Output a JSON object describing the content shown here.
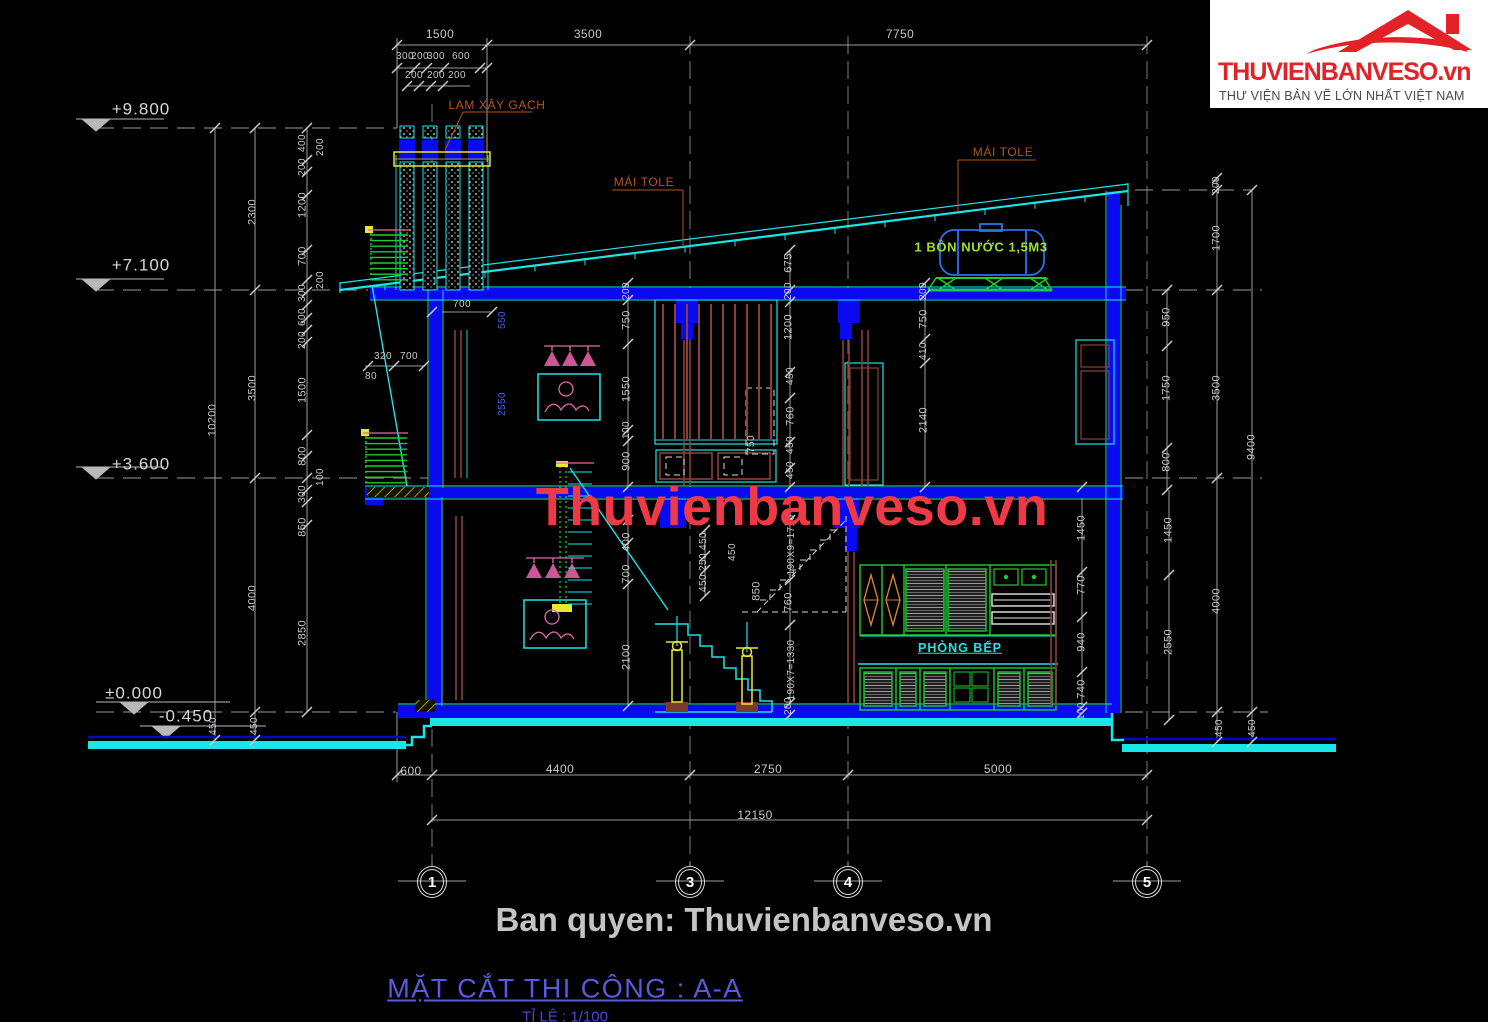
{
  "logo": {
    "brand": "THUVIENBANVESO.vn",
    "tagline": "THƯ VIỆN BẢN VẼ LỚN NHẤT VIỆT NAM"
  },
  "watermarks": {
    "center": "Thuvienbanveso.vn",
    "copyright": "Ban quyen: Thuvienbanveso.vn"
  },
  "title_block": {
    "title": "MẶT CẮT THI CÔNG : A-A",
    "scale": "TỈ LỆ : 1/100"
  },
  "grid_bubbles": [
    {
      "label": "1",
      "x": 432
    },
    {
      "label": "3",
      "x": 690
    },
    {
      "label": "4",
      "x": 848
    },
    {
      "label": "5",
      "x": 1147
    }
  ],
  "colors": {
    "background": "#000000",
    "dimension_gray": "#c9c9c9",
    "slab_blue": "#0a0af0",
    "outline_cyan": "#19e6e6",
    "fixture_green": "#18cf2f",
    "accent_pink": "#e06aa8",
    "label_orange": "#b5541c",
    "tank_label_green": "#9ee12c",
    "blue_dim_text": "#4a5cf0",
    "watermark_red": "#ee3a46",
    "title_blue": "#5a5ae0",
    "logo_red": "#e32227",
    "ground_cyan": "#19e6e6",
    "yellow": "#e8e832"
  },
  "annotation_labels": [
    {
      "t": "1500",
      "x": 440,
      "y": 34,
      "s": 12
    },
    {
      "t": "3500",
      "x": 588,
      "y": 34,
      "s": 12
    },
    {
      "t": "7750",
      "x": 900,
      "y": 34,
      "s": 12
    },
    {
      "t": "300",
      "x": 405,
      "y": 57,
      "s": 10
    },
    {
      "t": "200",
      "x": 420,
      "y": 57,
      "s": 10
    },
    {
      "t": "300",
      "x": 436,
      "y": 57,
      "s": 10
    },
    {
      "t": "600",
      "x": 461,
      "y": 57,
      "s": 10
    },
    {
      "t": "200",
      "x": 414,
      "y": 76,
      "s": 10
    },
    {
      "t": "200",
      "x": 436,
      "y": 76,
      "s": 10
    },
    {
      "t": "200",
      "x": 457,
      "y": 76,
      "s": 10
    },
    {
      "t": "+9.800",
      "x": 141,
      "y": 109,
      "c": "elev"
    },
    {
      "t": "+7.100",
      "x": 141,
      "y": 265,
      "c": "elev"
    },
    {
      "t": "+3.600",
      "x": 141,
      "y": 464,
      "c": "elev"
    },
    {
      "t": "±0.000",
      "x": 134,
      "y": 693,
      "c": "elev"
    },
    {
      "t": "-0.450",
      "x": 186,
      "y": 716,
      "c": "elev"
    },
    {
      "t": "10200",
      "x": 213,
      "y": 420,
      "r": 1
    },
    {
      "t": "2300",
      "x": 253,
      "y": 212,
      "r": 1
    },
    {
      "t": "3500",
      "x": 253,
      "y": 388,
      "r": 1
    },
    {
      "t": "4000",
      "x": 253,
      "y": 598,
      "r": 1
    },
    {
      "t": "450",
      "x": 214,
      "y": 726,
      "r": 1,
      "s": 10
    },
    {
      "t": "450",
      "x": 255,
      "y": 726,
      "r": 1,
      "s": 10
    },
    {
      "t": "400",
      "x": 303,
      "y": 143,
      "r": 1,
      "s": 10
    },
    {
      "t": "200",
      "x": 321,
      "y": 147,
      "r": 1,
      "s": 10
    },
    {
      "t": "200",
      "x": 303,
      "y": 167,
      "r": 1,
      "s": 10
    },
    {
      "t": "1200",
      "x": 303,
      "y": 205,
      "r": 1
    },
    {
      "t": "700",
      "x": 303,
      "y": 256,
      "r": 1
    },
    {
      "t": "200",
      "x": 321,
      "y": 280,
      "r": 1,
      "s": 10
    },
    {
      "t": "300",
      "x": 303,
      "y": 293,
      "r": 1,
      "s": 10
    },
    {
      "t": "600",
      "x": 303,
      "y": 317,
      "r": 1,
      "s": 10
    },
    {
      "t": "200",
      "x": 303,
      "y": 340,
      "r": 1,
      "s": 10
    },
    {
      "t": "1500",
      "x": 303,
      "y": 390,
      "r": 1
    },
    {
      "t": "800",
      "x": 303,
      "y": 456,
      "r": 1
    },
    {
      "t": "100",
      "x": 321,
      "y": 477,
      "r": 1,
      "s": 10
    },
    {
      "t": "300",
      "x": 303,
      "y": 494,
      "r": 1,
      "s": 10
    },
    {
      "t": "850",
      "x": 303,
      "y": 527,
      "r": 1
    },
    {
      "t": "2850",
      "x": 303,
      "y": 633,
      "r": 1
    },
    {
      "t": "320",
      "x": 383,
      "y": 357,
      "s": 10
    },
    {
      "t": "700",
      "x": 409,
      "y": 357,
      "s": 10
    },
    {
      "t": "80",
      "x": 371,
      "y": 377,
      "s": 10
    },
    {
      "t": "700",
      "x": 462,
      "y": 305,
      "s": 10
    },
    {
      "t": "550",
      "x": 503,
      "y": 320,
      "r": 1,
      "c": "blue",
      "s": 10
    },
    {
      "t": "2550",
      "x": 503,
      "y": 404,
      "r": 1,
      "c": "blue",
      "s": 10
    },
    {
      "t": "200",
      "x": 627,
      "y": 291,
      "r": 1,
      "s": 10
    },
    {
      "t": "750",
      "x": 627,
      "y": 320,
      "r": 1
    },
    {
      "t": "1550",
      "x": 627,
      "y": 389,
      "r": 1
    },
    {
      "t": "100",
      "x": 627,
      "y": 430,
      "r": 1,
      "s": 10
    },
    {
      "t": "900",
      "x": 627,
      "y": 461,
      "r": 1
    },
    {
      "t": "400",
      "x": 627,
      "y": 542,
      "r": 1
    },
    {
      "t": "700",
      "x": 627,
      "y": 574,
      "r": 1
    },
    {
      "t": "2100",
      "x": 627,
      "y": 657,
      "r": 1
    },
    {
      "t": "675",
      "x": 789,
      "y": 263,
      "r": 1
    },
    {
      "t": "200",
      "x": 789,
      "y": 291,
      "r": 1,
      "s": 10
    },
    {
      "t": "1200",
      "x": 789,
      "y": 327,
      "r": 1
    },
    {
      "t": "450",
      "x": 791,
      "y": 376,
      "r": 1,
      "s": 10
    },
    {
      "t": "760",
      "x": 791,
      "y": 416,
      "r": 1
    },
    {
      "t": "450",
      "x": 791,
      "y": 445,
      "r": 1,
      "s": 10
    },
    {
      "t": "450",
      "x": 791,
      "y": 470,
      "r": 1,
      "s": 10
    },
    {
      "t": "750",
      "x": 752,
      "y": 444,
      "r": 1,
      "s": 10
    },
    {
      "t": "450",
      "x": 704,
      "y": 541,
      "r": 1,
      "s": 10
    },
    {
      "t": "250",
      "x": 704,
      "y": 562,
      "r": 1,
      "s": 10
    },
    {
      "t": "450",
      "x": 704,
      "y": 583,
      "r": 1,
      "s": 10
    },
    {
      "t": "450",
      "x": 733,
      "y": 552,
      "r": 1,
      "s": 10
    },
    {
      "t": "850",
      "x": 757,
      "y": 591,
      "r": 1
    },
    {
      "t": "760",
      "x": 789,
      "y": 602,
      "r": 1
    },
    {
      "t": "190X9=1710",
      "x": 792,
      "y": 545,
      "r": 1,
      "s": 10
    },
    {
      "t": "190X7=1330",
      "x": 792,
      "y": 670,
      "r": 1,
      "s": 10
    },
    {
      "t": "200",
      "x": 789,
      "y": 706,
      "r": 1,
      "s": 10
    },
    {
      "t": "200",
      "x": 924,
      "y": 291,
      "r": 1,
      "s": 10
    },
    {
      "t": "750",
      "x": 924,
      "y": 319,
      "r": 1
    },
    {
      "t": "410",
      "x": 924,
      "y": 351,
      "r": 1,
      "s": 10
    },
    {
      "t": "2140",
      "x": 924,
      "y": 420,
      "r": 1
    },
    {
      "t": "200",
      "x": 1217,
      "y": 185,
      "r": 1,
      "s": 10
    },
    {
      "t": "1700",
      "x": 1217,
      "y": 238,
      "r": 1
    },
    {
      "t": "950",
      "x": 1167,
      "y": 317,
      "r": 1
    },
    {
      "t": "1750",
      "x": 1167,
      "y": 388,
      "r": 1
    },
    {
      "t": "800",
      "x": 1167,
      "y": 462,
      "r": 1
    },
    {
      "t": "3500",
      "x": 1217,
      "y": 388,
      "r": 1
    },
    {
      "t": "9400",
      "x": 1252,
      "y": 447,
      "r": 1
    },
    {
      "t": "1450",
      "x": 1082,
      "y": 528,
      "r": 1
    },
    {
      "t": "770",
      "x": 1082,
      "y": 585,
      "r": 1
    },
    {
      "t": "940",
      "x": 1082,
      "y": 642,
      "r": 1
    },
    {
      "t": "740",
      "x": 1082,
      "y": 689,
      "r": 1
    },
    {
      "t": "100",
      "x": 1082,
      "y": 711,
      "r": 1,
      "s": 10
    },
    {
      "t": "1450",
      "x": 1169,
      "y": 530,
      "r": 1
    },
    {
      "t": "2550",
      "x": 1169,
      "y": 642,
      "r": 1
    },
    {
      "t": "4000",
      "x": 1217,
      "y": 601,
      "r": 1
    },
    {
      "t": "450",
      "x": 1220,
      "y": 728,
      "r": 1,
      "s": 10
    },
    {
      "t": "450",
      "x": 1253,
      "y": 728,
      "r": 1,
      "s": 10
    },
    {
      "t": "600",
      "x": 411,
      "y": 771,
      "s": 12
    },
    {
      "t": "4400",
      "x": 560,
      "y": 769,
      "s": 12
    },
    {
      "t": "2750",
      "x": 768,
      "y": 769,
      "s": 12
    },
    {
      "t": "5000",
      "x": 998,
      "y": 769,
      "s": 12
    },
    {
      "t": "12150",
      "x": 755,
      "y": 815,
      "s": 12
    },
    {
      "t": "LAM XÂY GẠCH",
      "x": 497,
      "y": 105,
      "c": "orange",
      "n": "lam-xay-gach-label"
    },
    {
      "t": "MÁI TOLE",
      "x": 644,
      "y": 182,
      "c": "orange",
      "n": "mai-tole-label"
    },
    {
      "t": "MÁI TOLE",
      "x": 1003,
      "y": 152,
      "c": "orange",
      "n": "mai-tole-label"
    },
    {
      "t": "1 BỒN NƯỚC 1,5M3",
      "x": 981,
      "y": 247,
      "c": "lime",
      "n": "bon-nuoc-label"
    },
    {
      "t": "PHÒNG BẾP",
      "x": 960,
      "y": 648,
      "c": "cyanu",
      "n": "phong-bep-label"
    }
  ]
}
